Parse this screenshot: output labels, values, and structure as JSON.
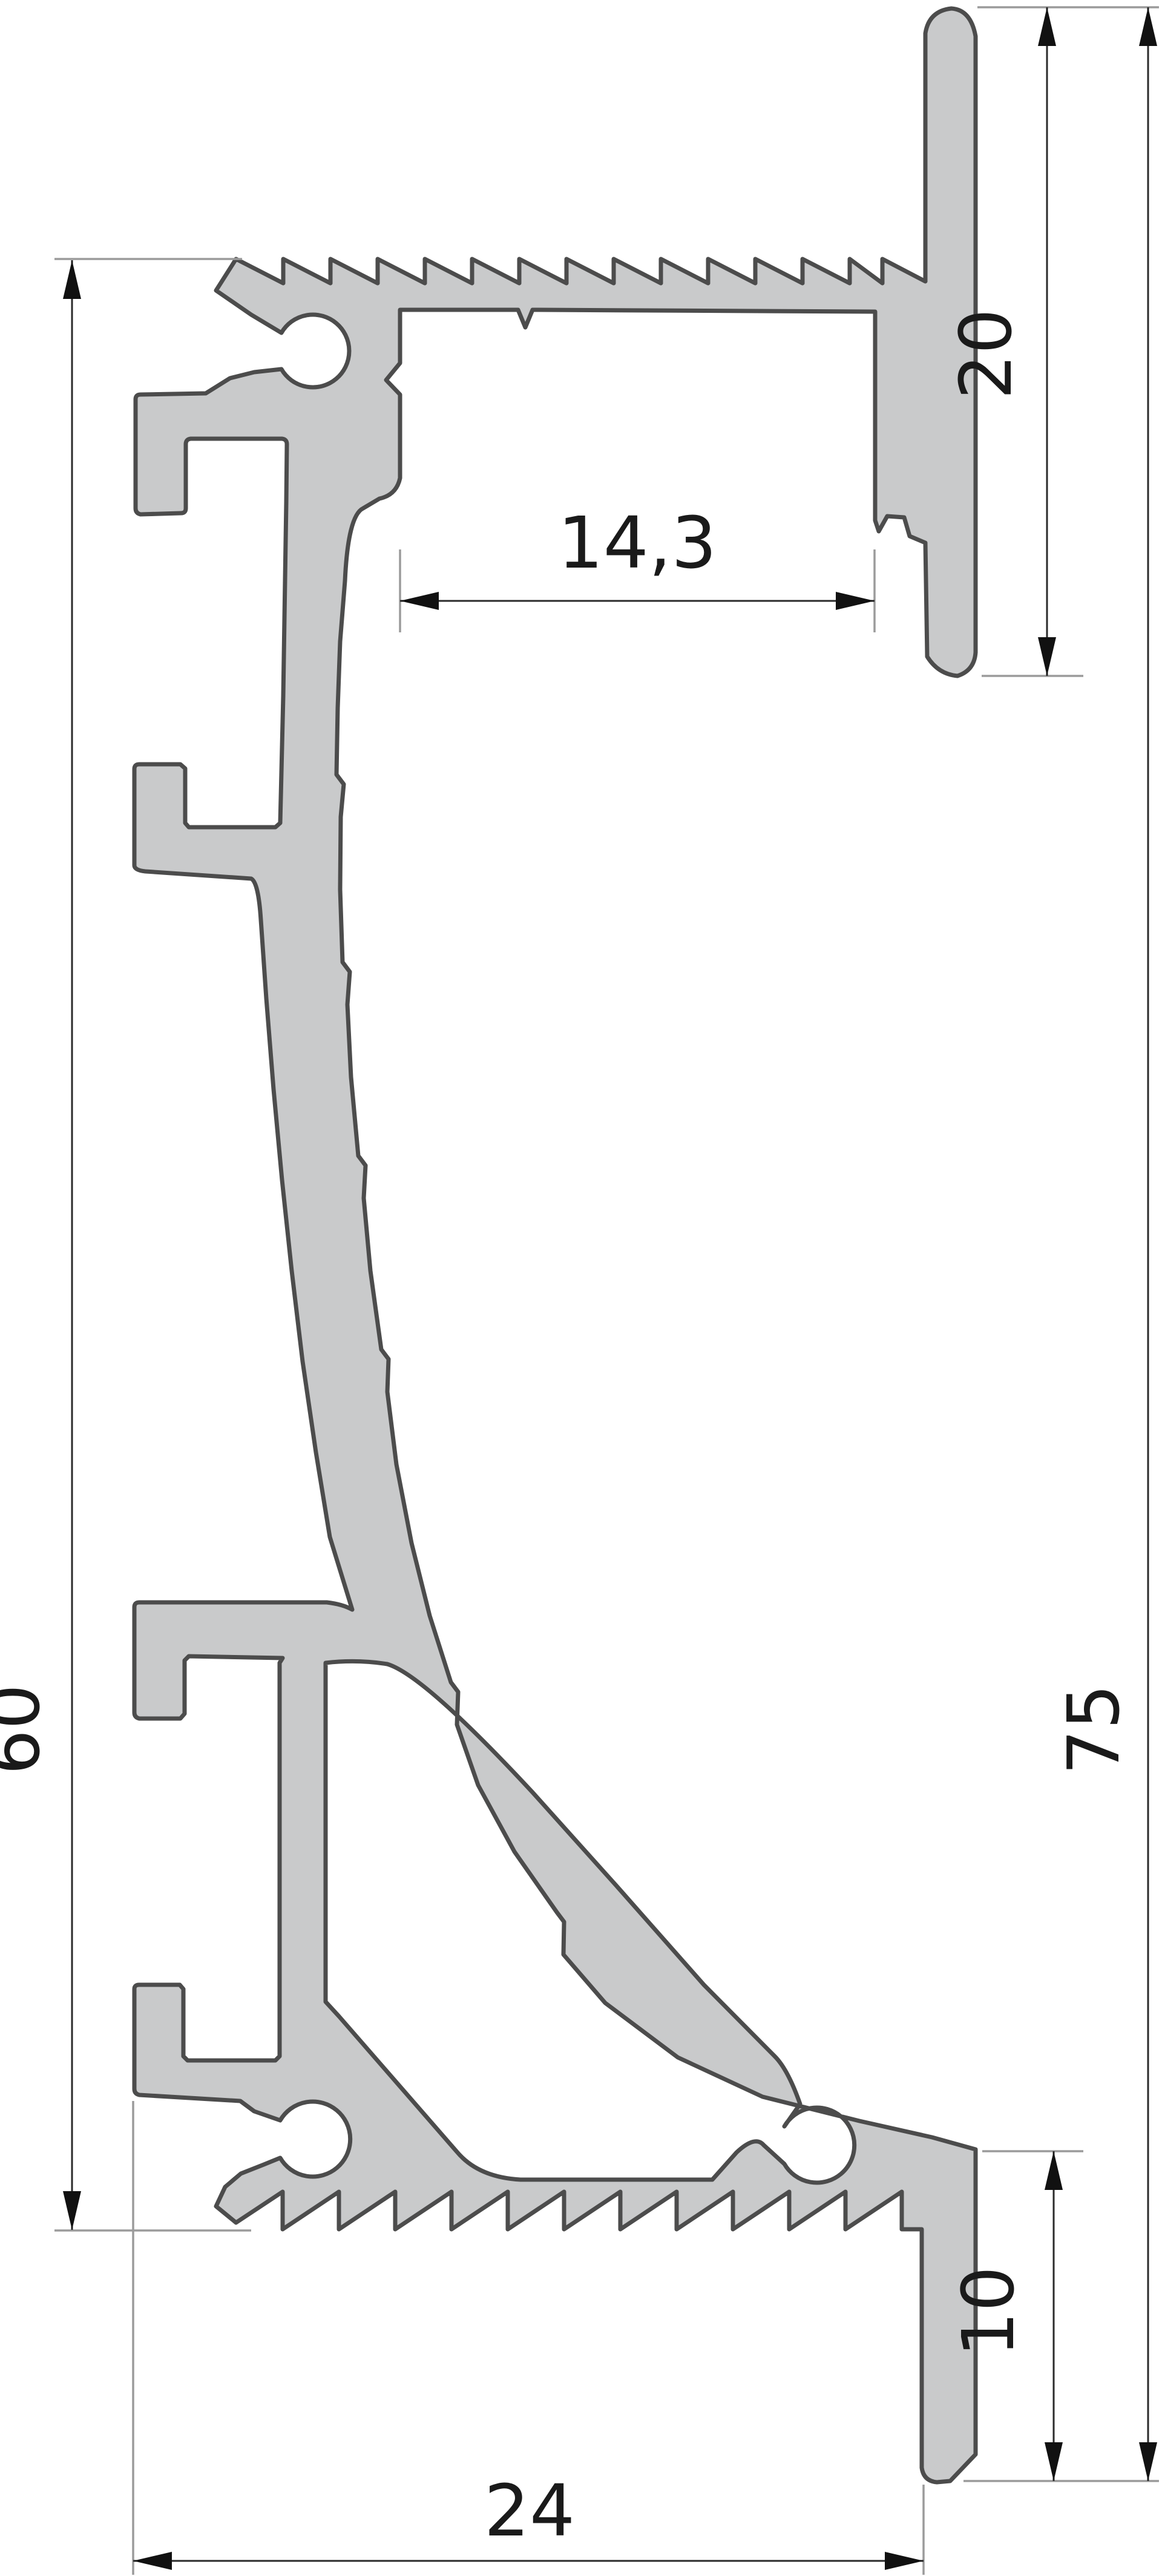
{
  "drawing": {
    "kind": "aluminium-profile-cross-section",
    "dimensions": {
      "channel_width": "14,3",
      "wall_flange_height": "20",
      "profile_height_left": "60",
      "total_height": "75",
      "leg_height": "10",
      "base_width": "24"
    },
    "colors": {
      "profile_fill": "#c9cacb",
      "profile_outline": "#4c4c4c",
      "dimension_line": "#2b2b2b",
      "extension_line": "#9b9b9b",
      "label": "#1a1a1a",
      "background": "#ffffff"
    }
  }
}
